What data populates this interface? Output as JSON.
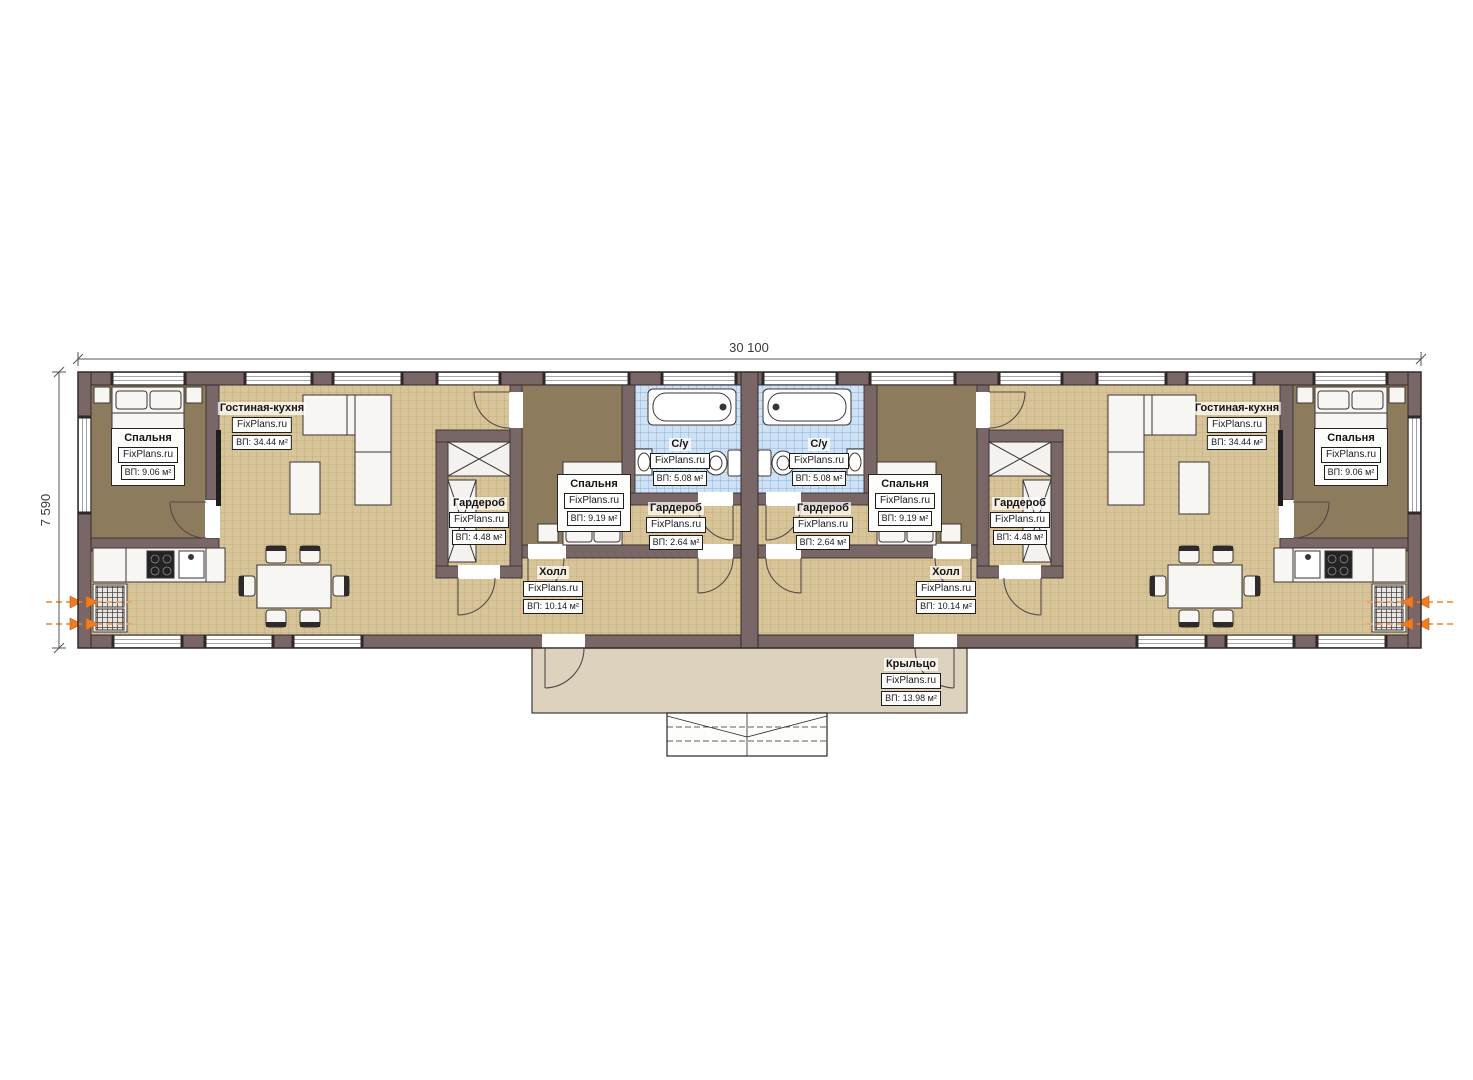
{
  "dimensions": {
    "width_label": "30 100",
    "height_label": "7 590"
  },
  "units": {
    "left": {
      "bedroom_top": {
        "name": "Спальня",
        "brand": "FixPlans.ru",
        "area": "ВП: 9.06 м²"
      },
      "living_kitchen": {
        "name": "Гостиная-кухня",
        "brand": "FixPlans.ru",
        "area": "ВП: 34.44 м²"
      },
      "wardrobe_large": {
        "name": "Гардероб",
        "brand": "FixPlans.ru",
        "area": "ВП: 4.48 м²"
      },
      "bedroom_mid": {
        "name": "Спальня",
        "brand": "FixPlans.ru",
        "area": "ВП: 9.19 м²"
      },
      "bathroom": {
        "name": "С/у",
        "brand": "FixPlans.ru",
        "area": "ВП: 5.08 м²"
      },
      "wardrobe_small": {
        "name": "Гардероб",
        "brand": "FixPlans.ru",
        "area": "ВП: 2.64 м²"
      },
      "hall": {
        "name": "Холл",
        "brand": "FixPlans.ru",
        "area": "ВП: 10.14 м²"
      }
    },
    "right": {
      "bedroom_top": {
        "name": "Спальня",
        "brand": "FixPlans.ru",
        "area": "ВП: 9.06 м²"
      },
      "living_kitchen": {
        "name": "Гостиная-кухня",
        "brand": "FixPlans.ru",
        "area": "ВП: 34.44 м²"
      },
      "wardrobe_large": {
        "name": "Гардероб",
        "brand": "FixPlans.ru",
        "area": "ВП: 4.48 м²"
      },
      "bedroom_mid": {
        "name": "Спальня",
        "brand": "FixPlans.ru",
        "area": "ВП: 9.19 м²"
      },
      "bathroom": {
        "name": "С/у",
        "brand": "FixPlans.ru",
        "area": "ВП: 5.08 м²"
      },
      "wardrobe_small": {
        "name": "Гардероб",
        "brand": "FixPlans.ru",
        "area": "ВП: 2.64 м²"
      },
      "hall": {
        "name": "Холл",
        "brand": "FixPlans.ru",
        "area": "ВП: 10.14 м²"
      }
    },
    "porch": {
      "name": "Крыльцо",
      "brand": "FixPlans.ru",
      "area": "ВП: 13.98 м²"
    }
  }
}
